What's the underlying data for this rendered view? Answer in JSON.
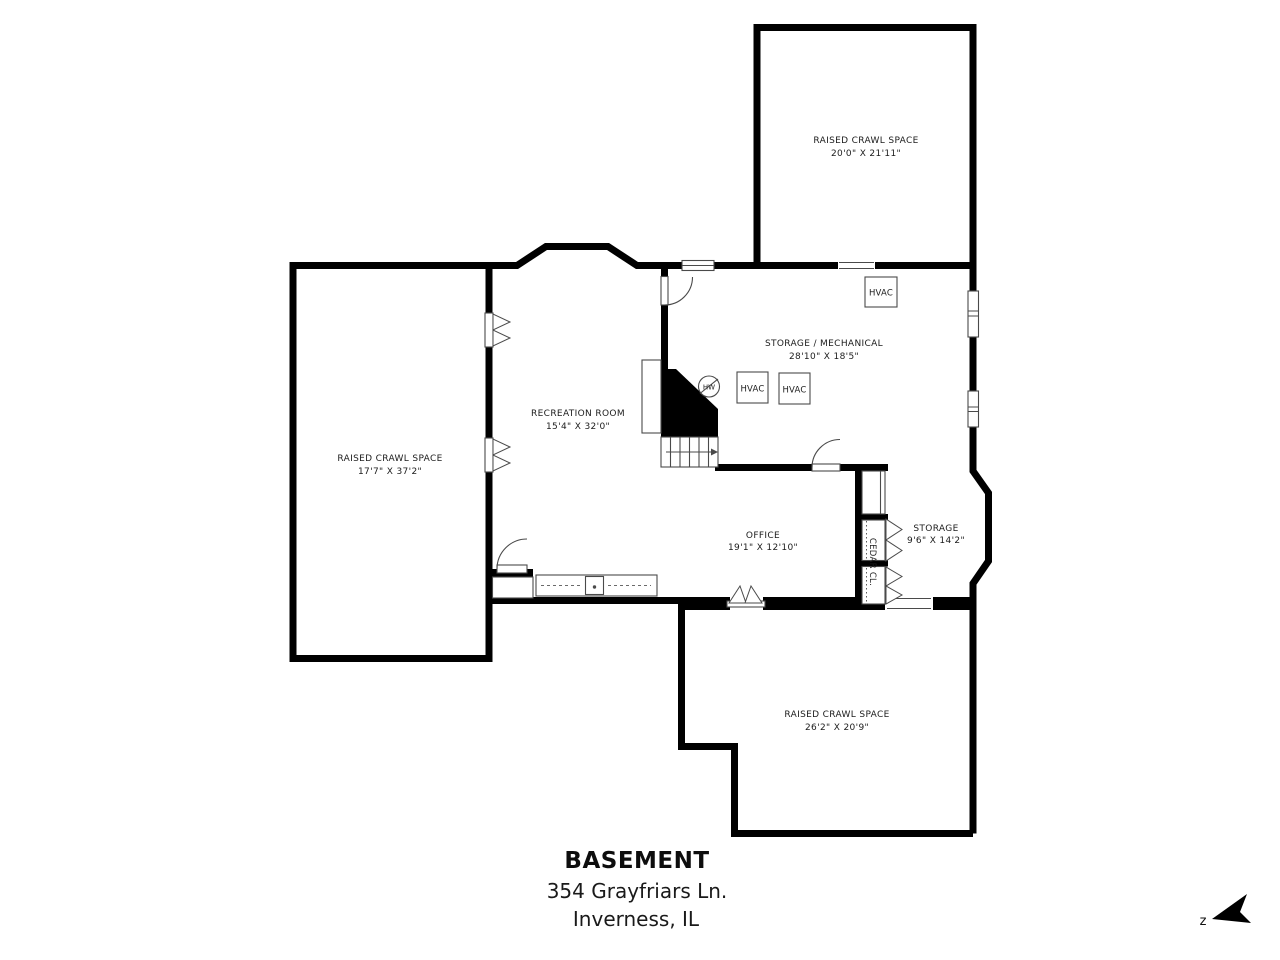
{
  "document": {
    "floor_title": "BASEMENT",
    "address_line1": "354 Grayfriars Ln.",
    "address_line2": "Inverness, IL",
    "north_label": "z"
  },
  "rooms": {
    "crawl_top": {
      "name": "RAISED CRAWL SPACE",
      "dims": "20'0\" X 21'11\""
    },
    "storage_mechanical": {
      "name": "STORAGE / MECHANICAL",
      "dims": "28'10\" X 18'5\""
    },
    "recreation": {
      "name": "RECREATION ROOM",
      "dims": "15'4\" X 32'0\""
    },
    "crawl_left": {
      "name": "RAISED CRAWL SPACE",
      "dims": "17'7\" X 37'2\""
    },
    "office": {
      "name": "OFFICE",
      "dims": "19'1\" X 12'10\""
    },
    "storage": {
      "name": "STORAGE",
      "dims": "9'6\" X 14'2\""
    },
    "crawl_bottom": {
      "name": "RAISED CRAWL SPACE",
      "dims": "26'2\" X 20'9\""
    },
    "cedar_closet": {
      "name": "CEDAR CL."
    }
  },
  "equipment": {
    "hvac_upper": "HVAC",
    "hvac_left": "HVAC",
    "hvac_right": "HVAC",
    "water_heater": "HW"
  },
  "colors": {
    "wall": "#000000",
    "background": "#ffffff",
    "symbol_line": "#4a4a4a",
    "text": "#1c1c1c"
  }
}
